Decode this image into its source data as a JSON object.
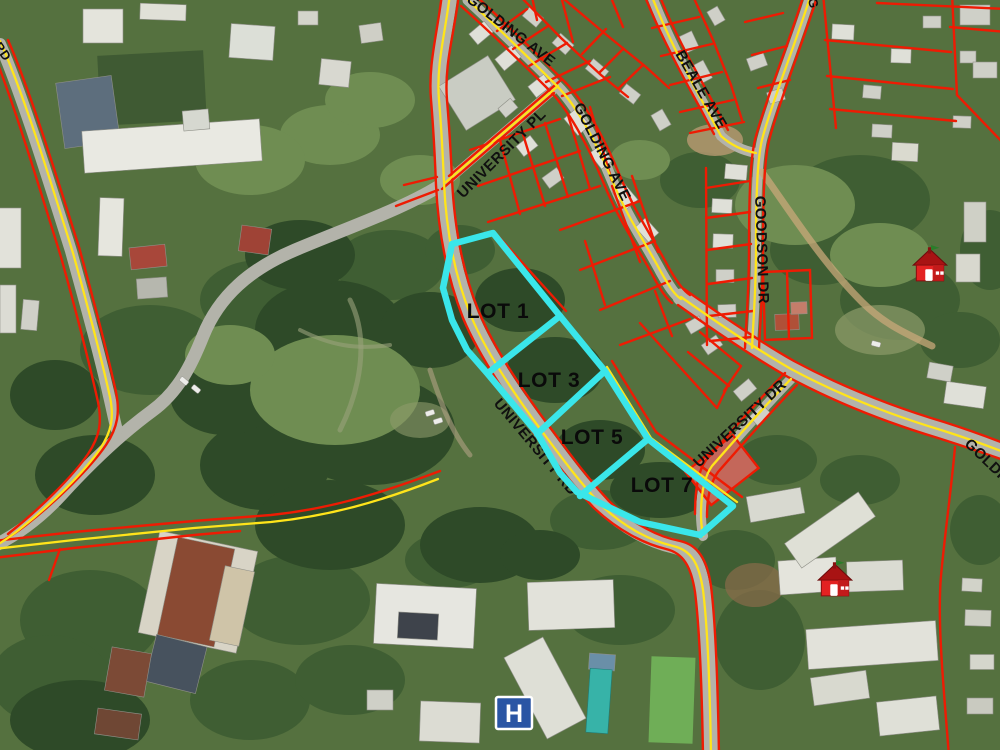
{
  "map": {
    "streets": [
      {
        "name": "golding-ave-top",
        "label": "GOLDING AVE"
      },
      {
        "name": "golding-ave-mid",
        "label": "GOLDING AVE"
      },
      {
        "name": "beale-ave",
        "label": "BEALE AVE"
      },
      {
        "name": "goodson-dr",
        "label": "GOODSON DR"
      },
      {
        "name": "university-pl",
        "label": "UNIVERSITY PL"
      },
      {
        "name": "university-rd",
        "label": "UNIVERSITY RD"
      },
      {
        "name": "university-dr",
        "label": "UNIVERSITY DR"
      },
      {
        "name": "golding-ave-east",
        "label": "GOLDING"
      },
      {
        "name": "left-edge-road-fragment",
        "label": "RD"
      },
      {
        "name": "top-edge-road-fragment",
        "label": "G"
      }
    ],
    "lots": [
      {
        "name": "lot-1",
        "label": "LOT 1"
      },
      {
        "name": "lot-3",
        "label": "LOT 3"
      },
      {
        "name": "lot-5",
        "label": "LOT 5"
      },
      {
        "name": "lot-7",
        "label": "LOT 7"
      }
    ],
    "markers": {
      "hospital": {
        "glyph": "H"
      },
      "school_icon_count": 2
    },
    "colors": {
      "lot_outline": "#3ae6ea",
      "parcel_line": "#ee1b03",
      "road_centerline": "#ffe41a",
      "hospital_blue": "#2a55a4",
      "school_red": "#e32222"
    }
  }
}
